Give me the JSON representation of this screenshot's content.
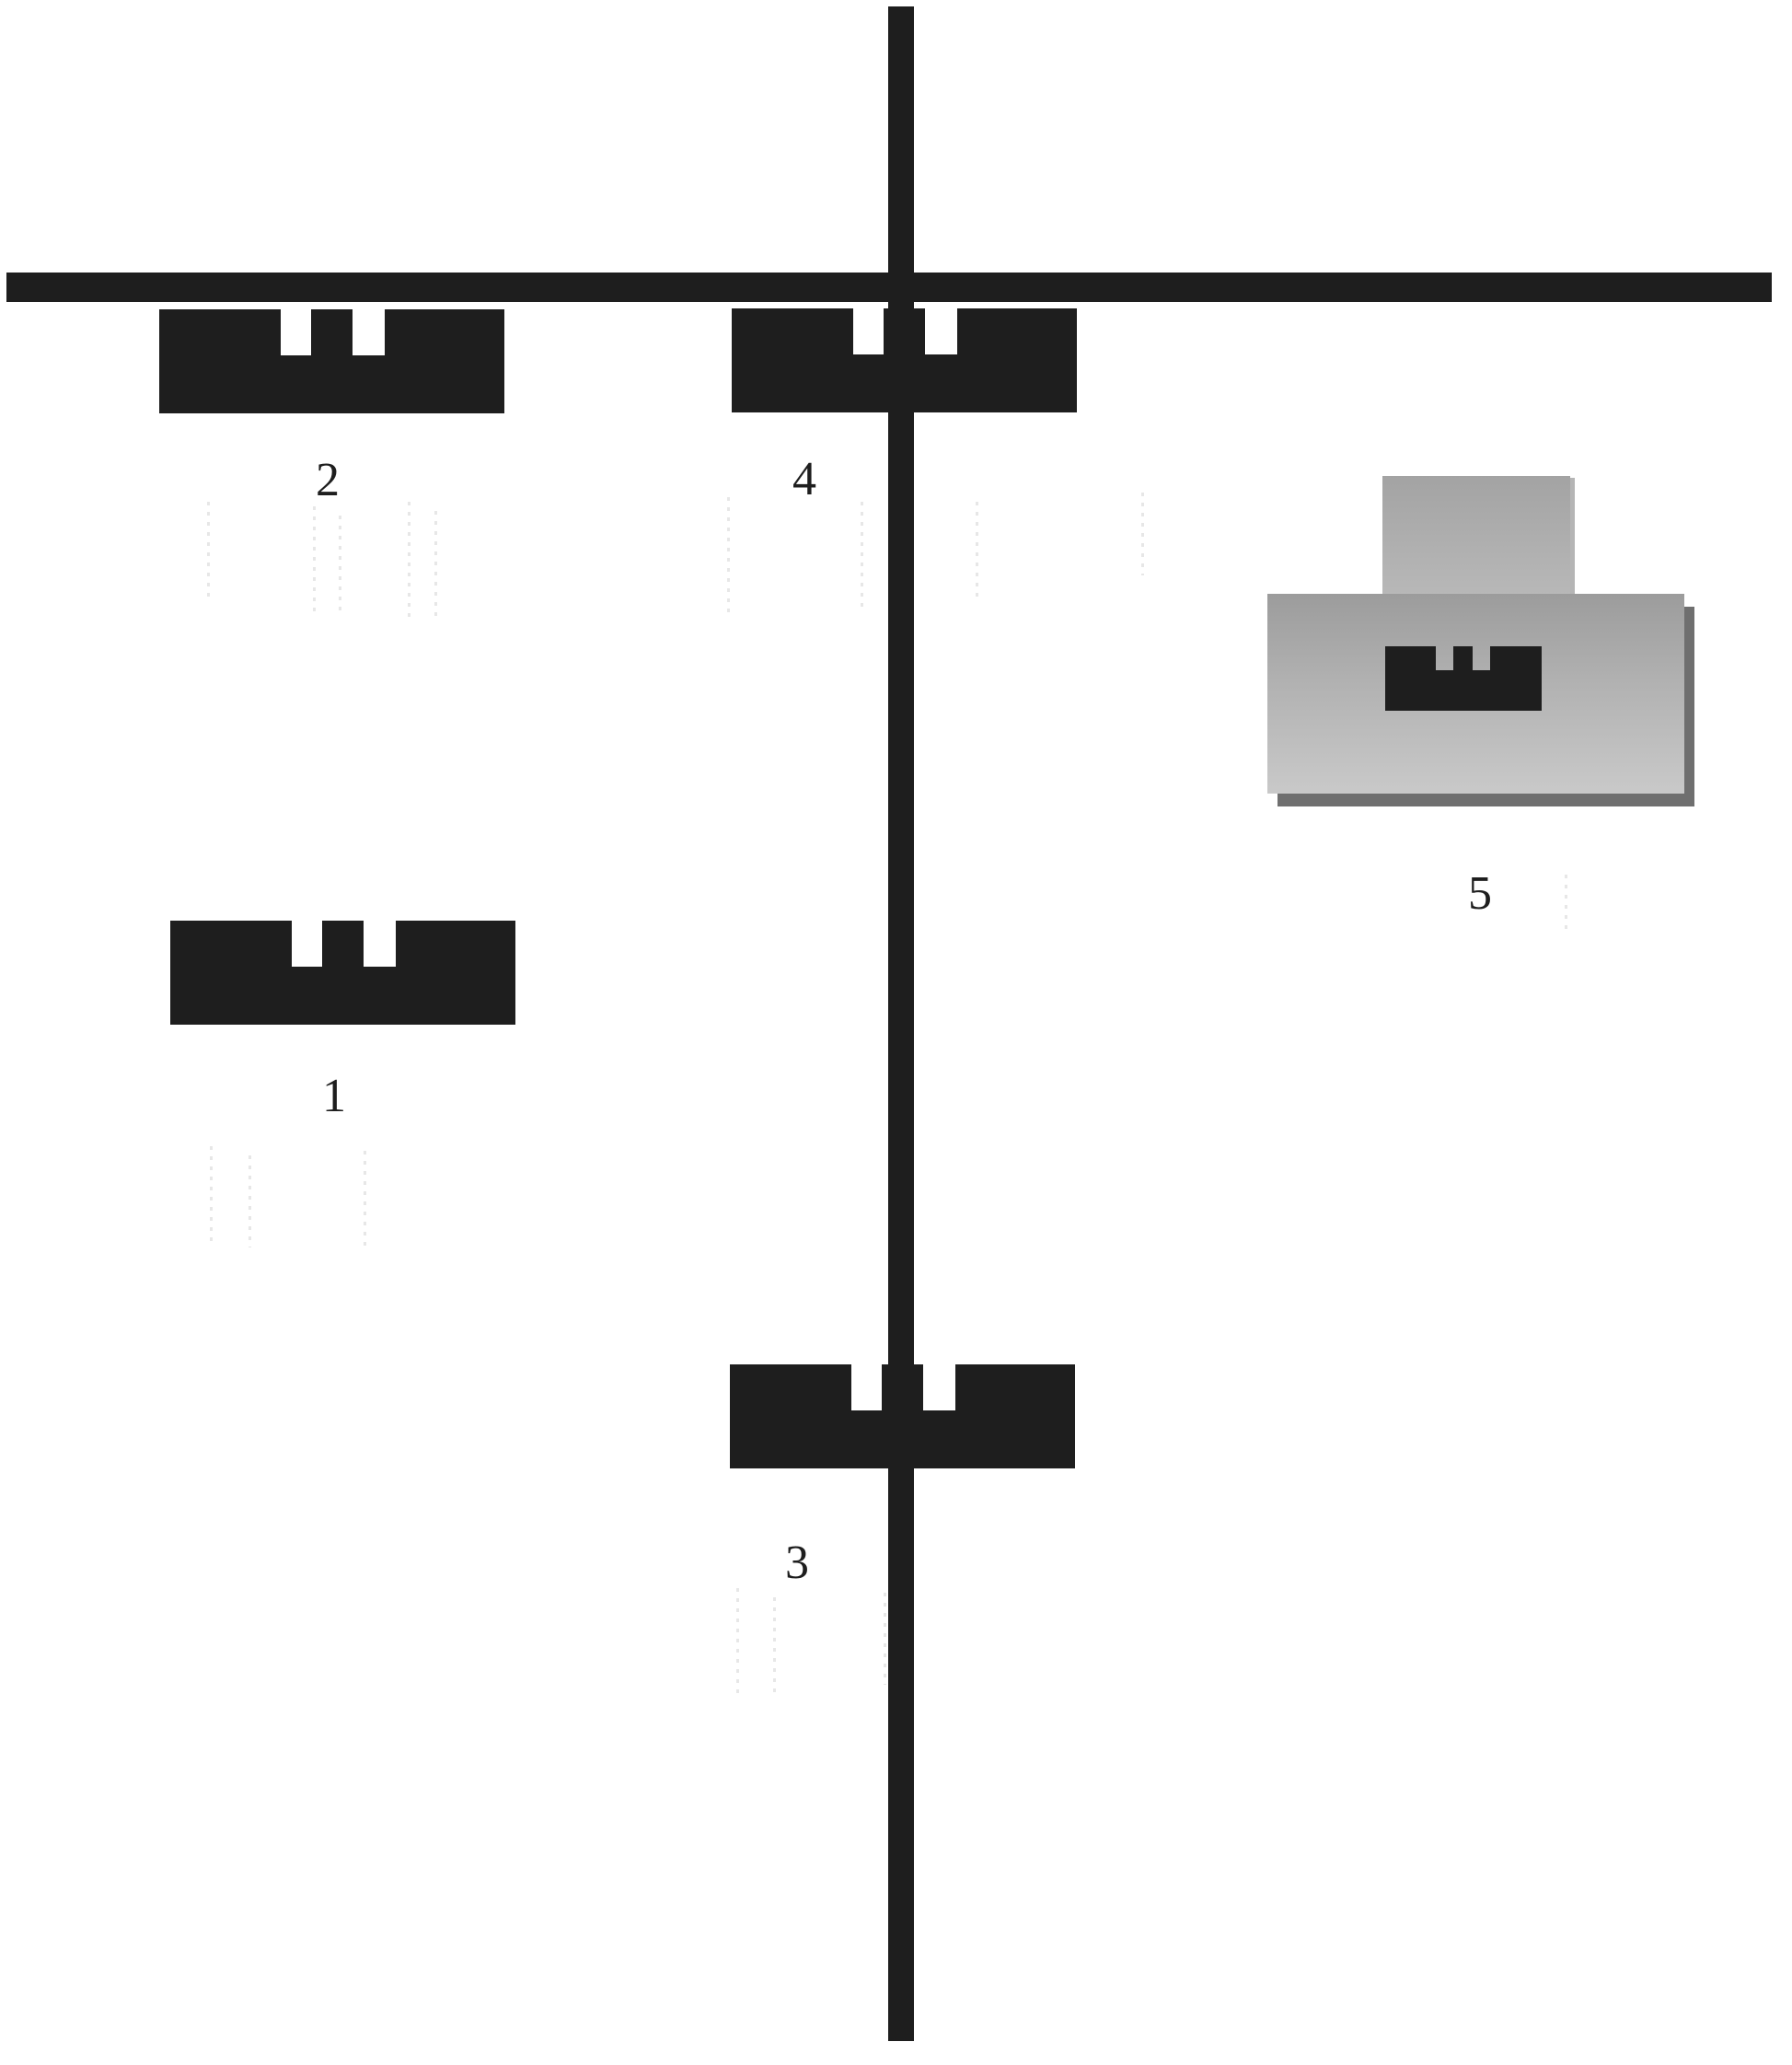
{
  "figure": {
    "labels": {
      "part1": "1",
      "part2": "2",
      "part3": "3",
      "part4": "4",
      "part5": "5"
    },
    "colors": {
      "background": "#ffffff",
      "ink": "#1e1e1e",
      "tab_top": "#a3a3a3",
      "tab_bottom": "#b8b8b8",
      "plate_top": "#9c9c9c",
      "plate_bottom": "#c9c9c9",
      "plate_shadow": "#6f6f6f"
    }
  }
}
